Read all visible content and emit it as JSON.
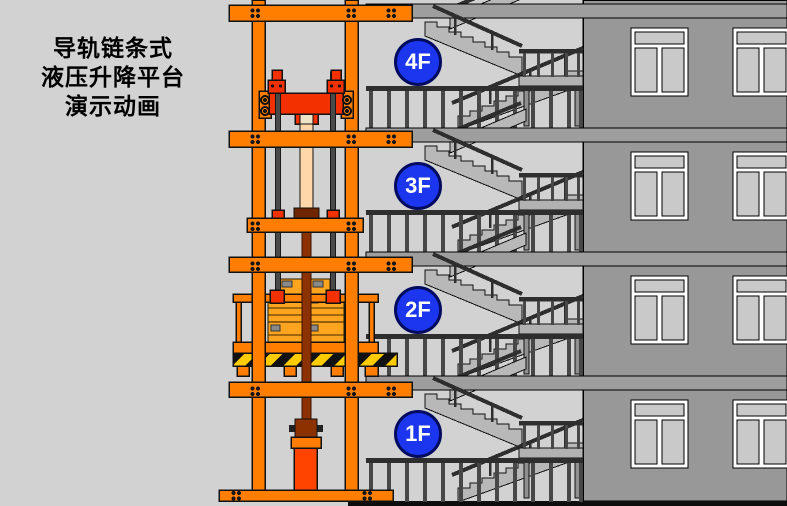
{
  "title": {
    "line1": "导轨链条式",
    "line2": "液压升降平台",
    "line3": "演示动画"
  },
  "floors": [
    {
      "label": "4F"
    },
    {
      "label": "3F"
    },
    {
      "label": "2F"
    },
    {
      "label": "1F"
    }
  ],
  "colors": {
    "background_gray": "#d2d2d2",
    "building_wall_gray": "#989898",
    "slab_gray": "#9e9e9e",
    "stair_gray": "#b8b8b8",
    "mast_orange": "#ff7e00",
    "carriage_red": "#f33000",
    "piston_peach": "#ffd7a8",
    "rod_brown": "#8c3100",
    "cylinder_orange_red": "#ff4400",
    "cargo_amber": "#ffa41e",
    "hazard_yellow": "#ffcc00",
    "floor_badge_blue": "#1b36ee",
    "ground_black": "#0d0d0d"
  }
}
